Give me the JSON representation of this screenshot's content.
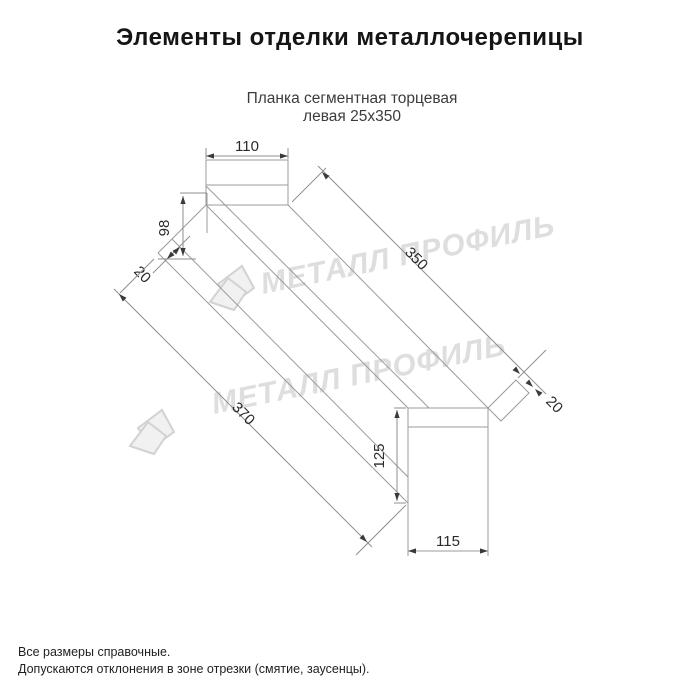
{
  "page": {
    "title": "Элементы отделки металлочерепицы"
  },
  "product": {
    "title_line1": "Планка сегментная торцевая",
    "title_line2": "левая 25x350"
  },
  "dimensions": {
    "top_width": "110",
    "left_height": "98",
    "left_hem": "20",
    "length_top": "350",
    "length_bottom": "370",
    "right_height": "125",
    "bottom_width": "115",
    "right_hem": "20"
  },
  "watermark": {
    "text": "МЕТАЛЛ ПРОФИЛЬ"
  },
  "footnotes": {
    "line1": "Все размеры справочные.",
    "line2": "Допускаются отклонения в зоне отрезки (смятие, заусенцы)."
  },
  "colors": {
    "background": "#ffffff",
    "drawing_line": "#9b9b9b",
    "dimension_text": "#2b2b2b",
    "title_text": "#151515",
    "subtitle_text": "#3c3c3c",
    "watermark": "#dedede"
  }
}
